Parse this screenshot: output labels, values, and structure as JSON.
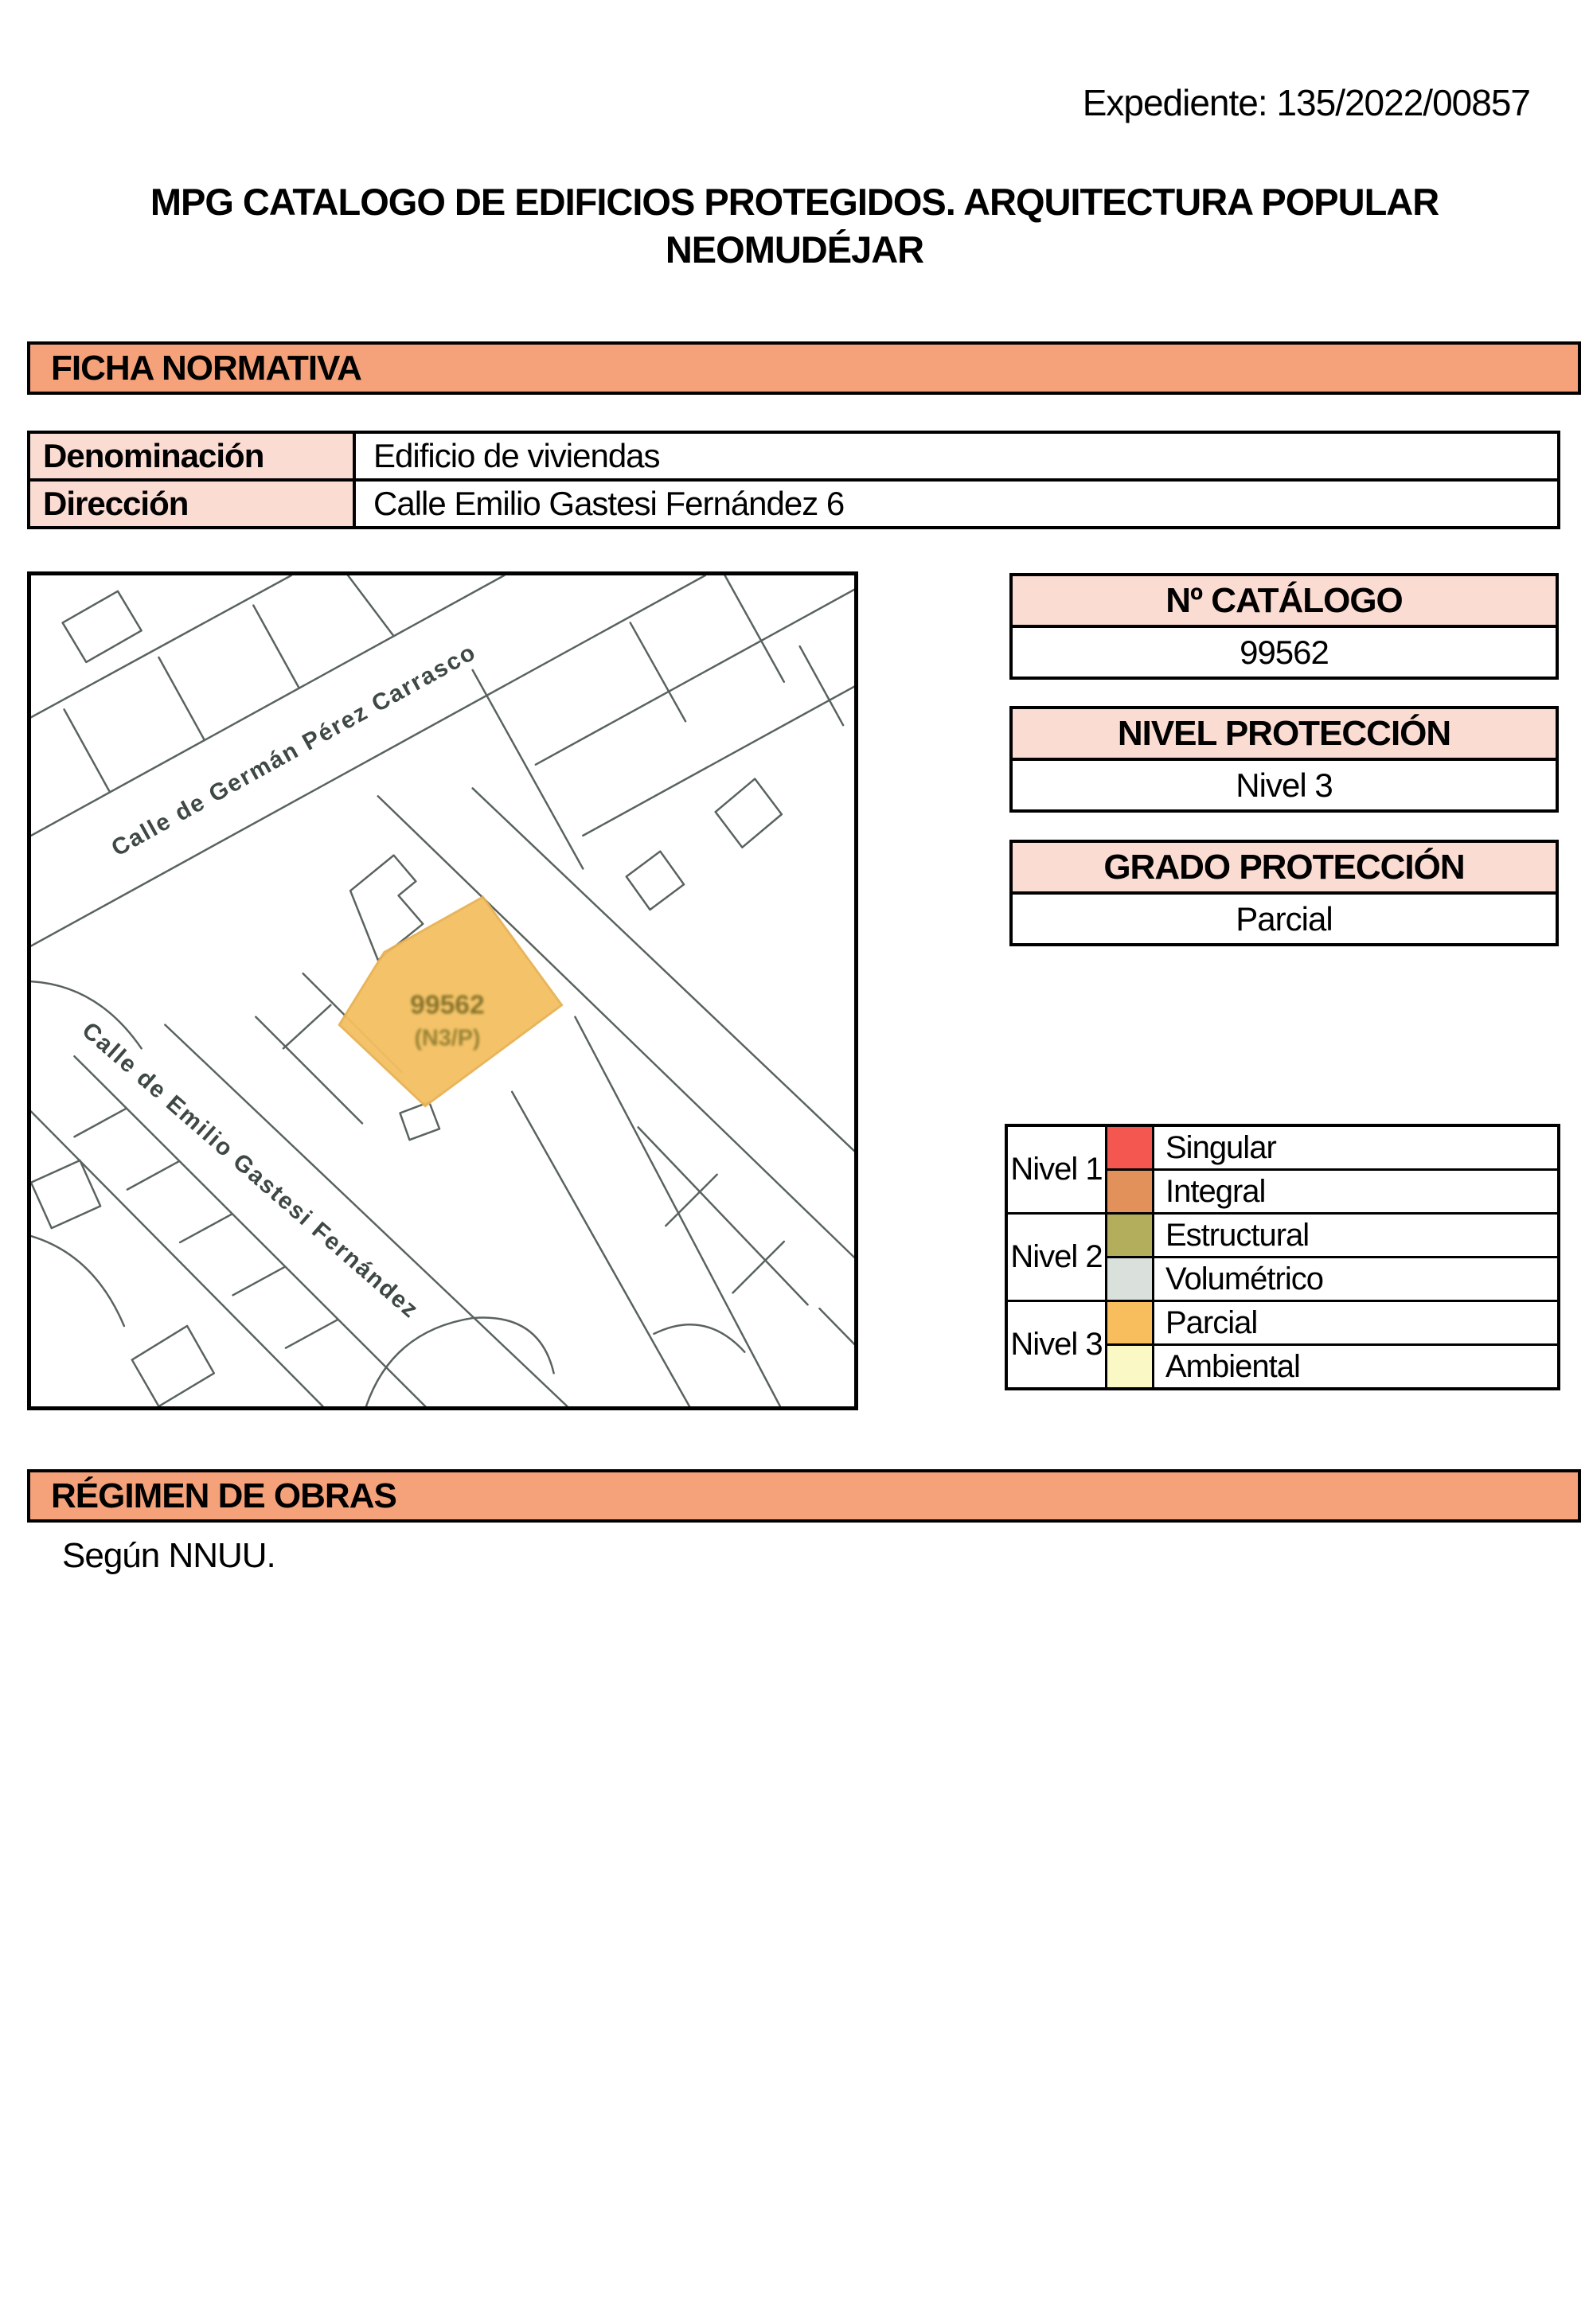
{
  "expediente": "Expediente: 135/2022/00857",
  "title": "MPG CATALOGO DE EDIFICIOS PROTEGIDOS. ARQUITECTURA POPULAR NEOMUDÉJAR",
  "ficha": {
    "header": "FICHA NORMATIVA"
  },
  "info": {
    "rows": [
      {
        "label": "Denominación",
        "value": "Edificio de viviendas"
      },
      {
        "label": "Dirección",
        "value": "Calle Emilio Gastesi Fernández 6"
      }
    ]
  },
  "map": {
    "street_1": "Calle de Germán Pérez Carrasco",
    "street_2": "Calle de Emilio Gastesi Fernández",
    "parcel_label": "99562",
    "parcel_sublabel": "(N3/P)"
  },
  "catalogo": {
    "header": "Nº CATÁLOGO",
    "value": "99562"
  },
  "nivel": {
    "header": "NIVEL PROTECCIÓN",
    "value": "Nivel 3"
  },
  "grado": {
    "header": "GRADO PROTECCIÓN",
    "value": "Parcial"
  },
  "legend": {
    "groups": [
      {
        "level": "Nivel 1",
        "entries": [
          {
            "label": "Singular",
            "color": "#f4574f"
          },
          {
            "label": "Integral",
            "color": "#e19159"
          }
        ]
      },
      {
        "level": "Nivel 2",
        "entries": [
          {
            "label": "Estructural",
            "color": "#b3ae5b"
          },
          {
            "label": "Volumétrico",
            "color": "#dae1dd"
          }
        ]
      },
      {
        "level": "Nivel 3",
        "entries": [
          {
            "label": "Parcial",
            "color": "#f8be5d"
          },
          {
            "label": "Ambiental",
            "color": "#faf8c5"
          }
        ]
      }
    ]
  },
  "regimen": {
    "header": "RÉGIMEN DE OBRAS",
    "body": "Según NNUU."
  },
  "colors": {
    "bar_bg": "#f5a27b",
    "cell_pink": "#fbdcd2",
    "map_line": "#4c5650",
    "parcel_fill": "#f4c061",
    "parcel_stroke": "#e8b254",
    "parcel_text": "#7c6b25"
  }
}
